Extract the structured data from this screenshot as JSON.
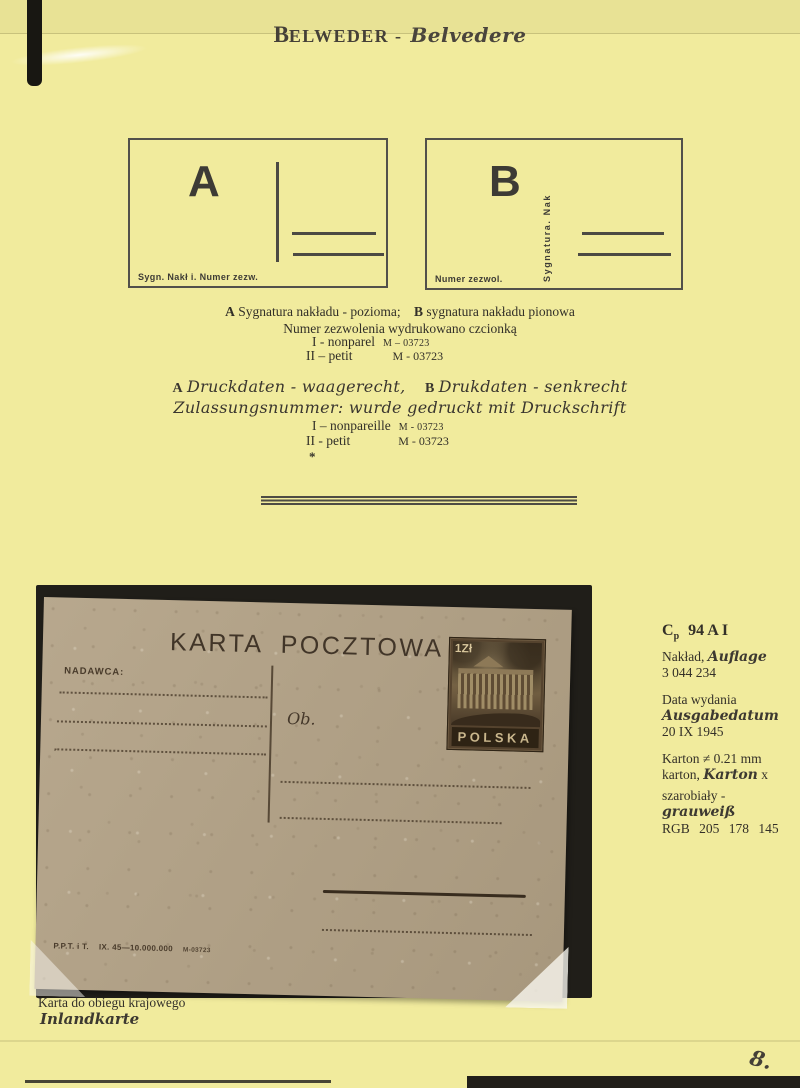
{
  "page": {
    "title_initial": "B",
    "title_rest": "ELWEDER -",
    "title_script": "Belvedere",
    "page_number": "8."
  },
  "diagrams": {
    "a": {
      "letter": "A",
      "caption": "Sygn. Nakł i.  Numer zezw."
    },
    "b": {
      "letter": "B",
      "vertical_label": "Sygnatura. Nak",
      "caption": "Numer zezwol."
    }
  },
  "polish_note": {
    "l1_a": "A",
    "l1_t1": "Sygnatura nakładu - pozioma;",
    "l1_b": "B",
    "l1_t2": "sygnatura nakładu pionowa",
    "l2": "Numer zezwolenia wydrukowano czcionką",
    "l3_label": "I - nonparel",
    "l3_code": "M – 03723",
    "l4_label": "II – petit",
    "l4_code": "M - 03723"
  },
  "german_note": {
    "l1_a": "A",
    "l1_t1": "Druckdaten - waagerecht,",
    "l1_b": "B",
    "l1_t2": "Drukdaten - senkrecht",
    "l2": "Zulassungsnummer: wurde gedruckt mit Druckschrift",
    "l3_label": "I – nonpareille",
    "l3_code": "M - 03723",
    "l4_label": "II - petit",
    "l4_code": "M - 03723",
    "footnote_mark": "*"
  },
  "postcard": {
    "title": "KARTA POCZTOWA",
    "sender_label": "NADAWCA:",
    "addressee_label": "Ob.",
    "stamp": {
      "denomination": "1Zł",
      "country": "POLSKA"
    },
    "imprint_left": "P.P.T. i T.",
    "imprint_mid": "IX. 45—10.000.000",
    "imprint_code": "M-03723"
  },
  "caption": {
    "polish": "Karta do obiegu krajowego",
    "german": "Inlandkarte"
  },
  "catalog": {
    "code_main": "C",
    "code_sub": "p",
    "code_rest": "94 A I",
    "edition_pl": "Nakład,",
    "edition_de": "Auflage",
    "edition_value": "3 044 234",
    "date_pl": "Data wydania",
    "date_de": "Ausgabedatum",
    "date_value": "20 IX 1945",
    "card_line1": "Karton ≠ 0.21 mm",
    "card_line2_pl": "karton,",
    "card_line2_de": "Karton",
    "card_line2_x": "x",
    "color_pl": "szarobiały -",
    "color_de": "grauweiß",
    "rgb_value": "RGB 205 178 145"
  },
  "colors": {
    "page_bg": "#f1eb9d",
    "ink": "#322f28",
    "card_bg": "#b2a185",
    "card_ink": "#42362a",
    "mat": "#201e19",
    "stamp_dark": "#55432e"
  }
}
